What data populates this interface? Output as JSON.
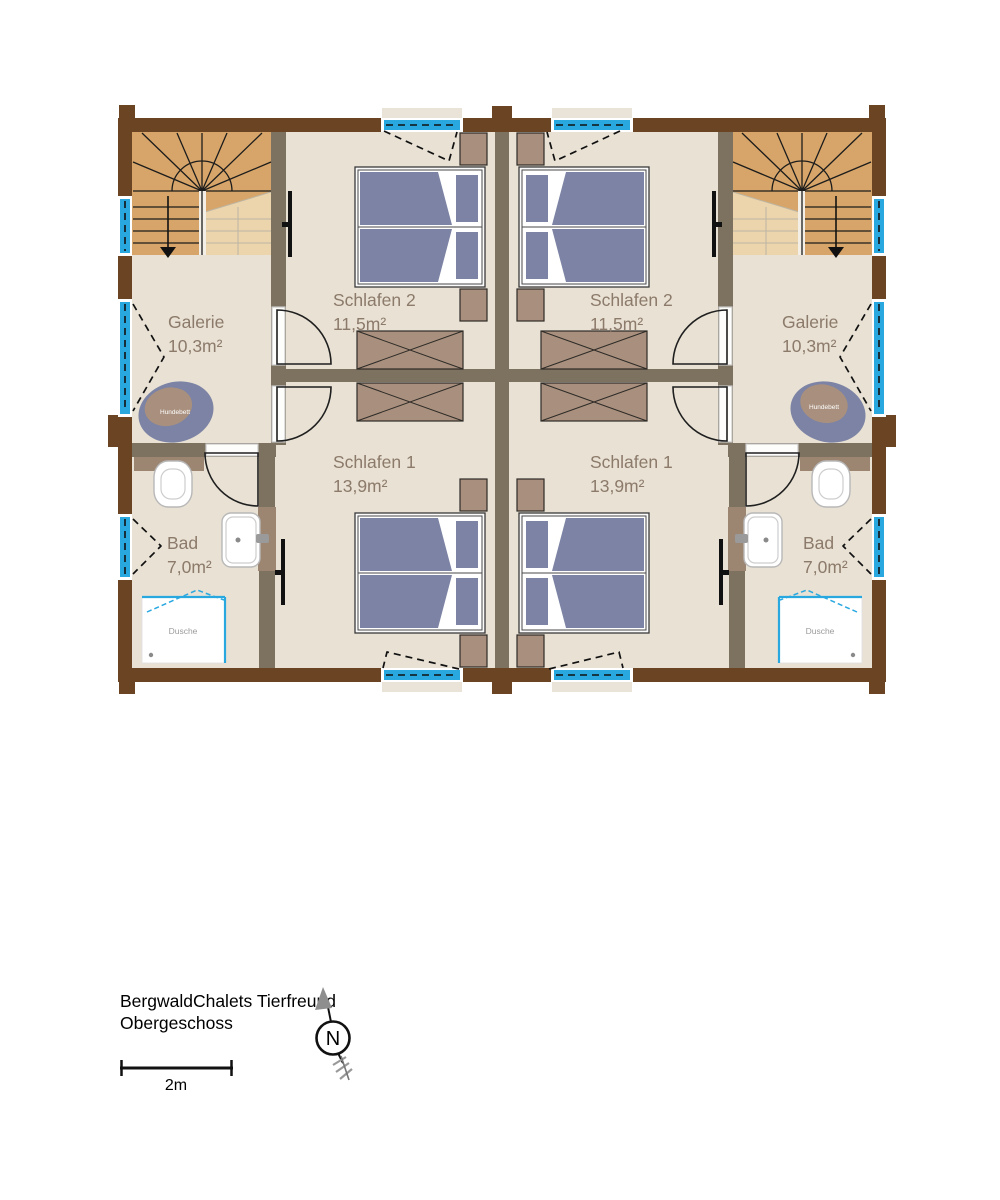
{
  "title": {
    "line1": "BergwaldChalets Tierfreund",
    "line2": "Obergeschoss"
  },
  "scale_bar": {
    "label": "2m"
  },
  "compass": {
    "label": "N"
  },
  "rooms": [
    {
      "id": "galerie-left",
      "name": "Galerie",
      "area": "10,3m²"
    },
    {
      "id": "schlafen2-left",
      "name": "Schlafen 2",
      "area": "11,5m²"
    },
    {
      "id": "schlafen1-left",
      "name": "Schlafen 1",
      "area": "13,9m²"
    },
    {
      "id": "bad-left",
      "name": "Bad",
      "area": "7,0m²"
    },
    {
      "id": "galerie-right",
      "name": "Galerie",
      "area": "10,3m²"
    },
    {
      "id": "schlafen2-right",
      "name": "Schlafen 2",
      "area": "11,5m²"
    },
    {
      "id": "schlafen1-right",
      "name": "Schlafen 1",
      "area": "13,9m²"
    },
    {
      "id": "bad-right",
      "name": "Bad",
      "area": "7,0m²"
    }
  ],
  "fixtures": {
    "dog_bed_label": "Hundebett",
    "shower_label": "Dusche"
  },
  "colors": {
    "wall_exterior": "#6b4423",
    "wall_interior": "#7d7160",
    "floor": "#e8e1d4",
    "stair": "#d7a569",
    "stair_light": "#ecd4ad",
    "window_blue": "#29a8e0",
    "bed_blue": "#7c83a4",
    "furniture_tan": "#a9907e",
    "fixture_tan": "#9c8672",
    "label_text": "#8c7a6a"
  }
}
